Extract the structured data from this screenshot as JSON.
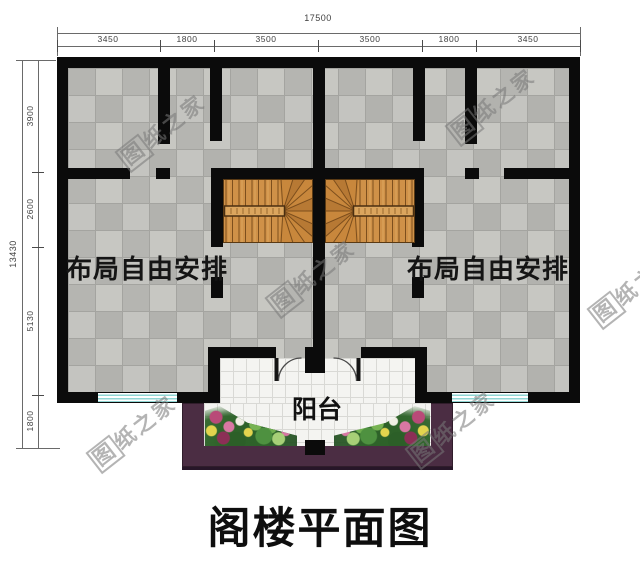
{
  "title": "阁楼平面图",
  "rooms": {
    "left_label": "布局自由安排",
    "right_label": "布局自由安排",
    "balcony_label": "阳台"
  },
  "watermark": {
    "first": "图",
    "rest": "纸之家"
  },
  "dimensions": {
    "top": {
      "total": "17500",
      "segments": [
        "3450",
        "1800",
        "3500",
        "3500",
        "1800",
        "3450"
      ]
    },
    "left": {
      "total": "13430",
      "segments": [
        "3900",
        "2600",
        "5130",
        "1800"
      ]
    }
  },
  "colors": {
    "wall": "#0b0b0b",
    "stair_wood": "#cf9148",
    "balcony_wall": "#4b2d43",
    "window_glass": "#8fd6d4",
    "floor_tile": "#bcbcb8",
    "balcony_tile": "#f4f4f1"
  }
}
